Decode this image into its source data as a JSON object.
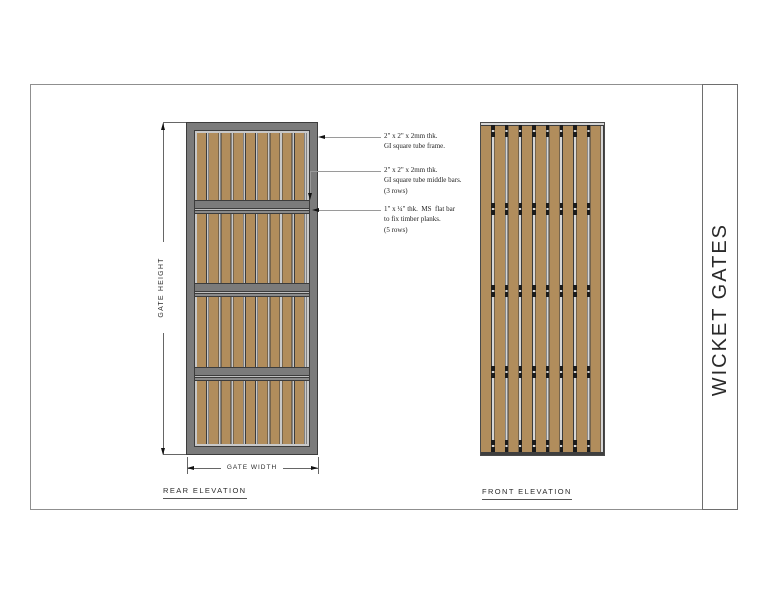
{
  "title_block": {
    "title": "WICKET GATES"
  },
  "rear": {
    "label": "REAR ELEVATION",
    "gate_height_label": "GATE HEIGHT",
    "gate_width_label": "GATE WIDTH"
  },
  "front": {
    "label": "FRONT ELEVATION"
  },
  "annotations": [
    {
      "lines": [
        "2\" x 2\" x 2mm thk.",
        "GI square tube frame."
      ]
    },
    {
      "lines": [
        "2\" x 2\" x 2mm thk.",
        "GI square tube middle bars.",
        "(3 rows)"
      ]
    },
    {
      "lines": [
        "1\" x ¼\" thk.  MS  flat bar",
        "to fix timber planks.",
        "(5 rows)"
      ]
    }
  ],
  "colors": {
    "plank-brown": "#b18d5c",
    "frame-gray": "#7b7b7b",
    "flatbar-gray": "#8a8a8a",
    "line-dark": "#3c3c3c",
    "gap-light": "#d6d6d6",
    "margin-light": "#c8c8c8",
    "screw-black": "#1b1b1b"
  }
}
